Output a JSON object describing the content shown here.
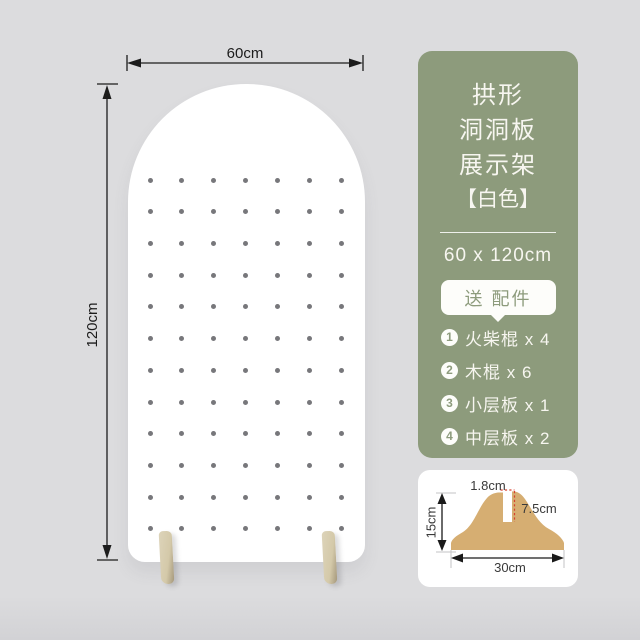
{
  "colors": {
    "background": "#dcdcde",
    "panel_green": "#8d9b7c",
    "board_white": "#ffffff",
    "peg_hole_gray": "#77777b",
    "foot_beige": "#d4c9a9",
    "diagram_tan": "#d6ae72",
    "dimension_black": "#1c1c1c",
    "diagram_red": "#d8402e"
  },
  "board": {
    "width_label": "60cm",
    "height_label": "120cm",
    "pegboard": {
      "rows": 12,
      "cols": 7
    }
  },
  "panel": {
    "title_lines": [
      "拱形",
      "洞洞板",
      "展示架"
    ],
    "variant": "【白色】",
    "size": "60 x 120cm",
    "gift_badge": "送 配件",
    "accessories": [
      {
        "num": "1",
        "label": "火柴棍 x 4"
      },
      {
        "num": "2",
        "label": "木棍 x 6"
      },
      {
        "num": "3",
        "label": "小层板 x 1"
      },
      {
        "num": "4",
        "label": "中层板 x 2"
      }
    ]
  },
  "foot_diagram": {
    "slot_width": "1.8cm",
    "slot_depth": "7.5cm",
    "height": "15cm",
    "width": "30cm"
  }
}
